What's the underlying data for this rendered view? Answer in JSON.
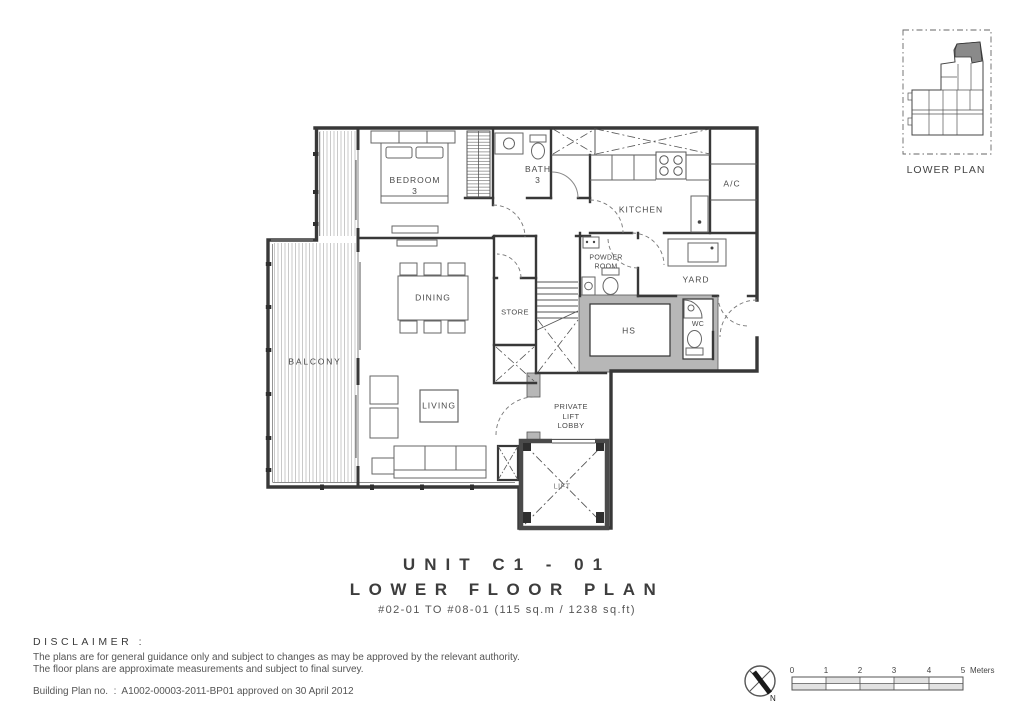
{
  "title": {
    "unit": "UNIT C1 - 01",
    "floor": "LOWER FLOOR PLAN",
    "detail": "#02-01 TO #08-01 (115 sq.m / 1238 sq.ft)"
  },
  "plan": {
    "rooms": {
      "bedroom3": [
        "BEDROOM",
        "3"
      ],
      "bath3": [
        "BATH",
        "3"
      ],
      "kitchen": [
        "KITCHEN"
      ],
      "ac": [
        "A/C"
      ],
      "dining": [
        "DINING"
      ],
      "store": [
        "STORE"
      ],
      "powder_room": [
        "POWDER",
        "ROOM"
      ],
      "yard": [
        "YARD"
      ],
      "hs": [
        "HS"
      ],
      "wc": [
        "WC"
      ],
      "balcony": [
        "BALCONY"
      ],
      "living": [
        "LIVING"
      ],
      "private_lift_lobby": [
        "PRIVATE",
        "LIFT",
        "LOBBY"
      ],
      "lift": [
        "LIFT"
      ]
    }
  },
  "key_plan": {
    "label": "LOWER PLAN"
  },
  "disclaimer": {
    "heading": "DISCLAIMER :",
    "line1": "The plans are for general guidance only and subject to changes as may be approved by the relevant authority.",
    "line2": "The floor plans are approximate measurements and subject to final survey.",
    "building_plan": "Building Plan no.  :  A1002-00003-2011-BP01 approved on 30 April 2012"
  },
  "scale_bar": {
    "ticks": [
      "0",
      "1",
      "2",
      "3",
      "4",
      "5"
    ],
    "unit": "Meters"
  },
  "compass": {
    "north": "N"
  },
  "colors": {
    "line": "#3a3a3a",
    "wall_fill": "#b7b7b7",
    "keyplan_highlight": "#8a8a8a",
    "background": "#ffffff"
  }
}
